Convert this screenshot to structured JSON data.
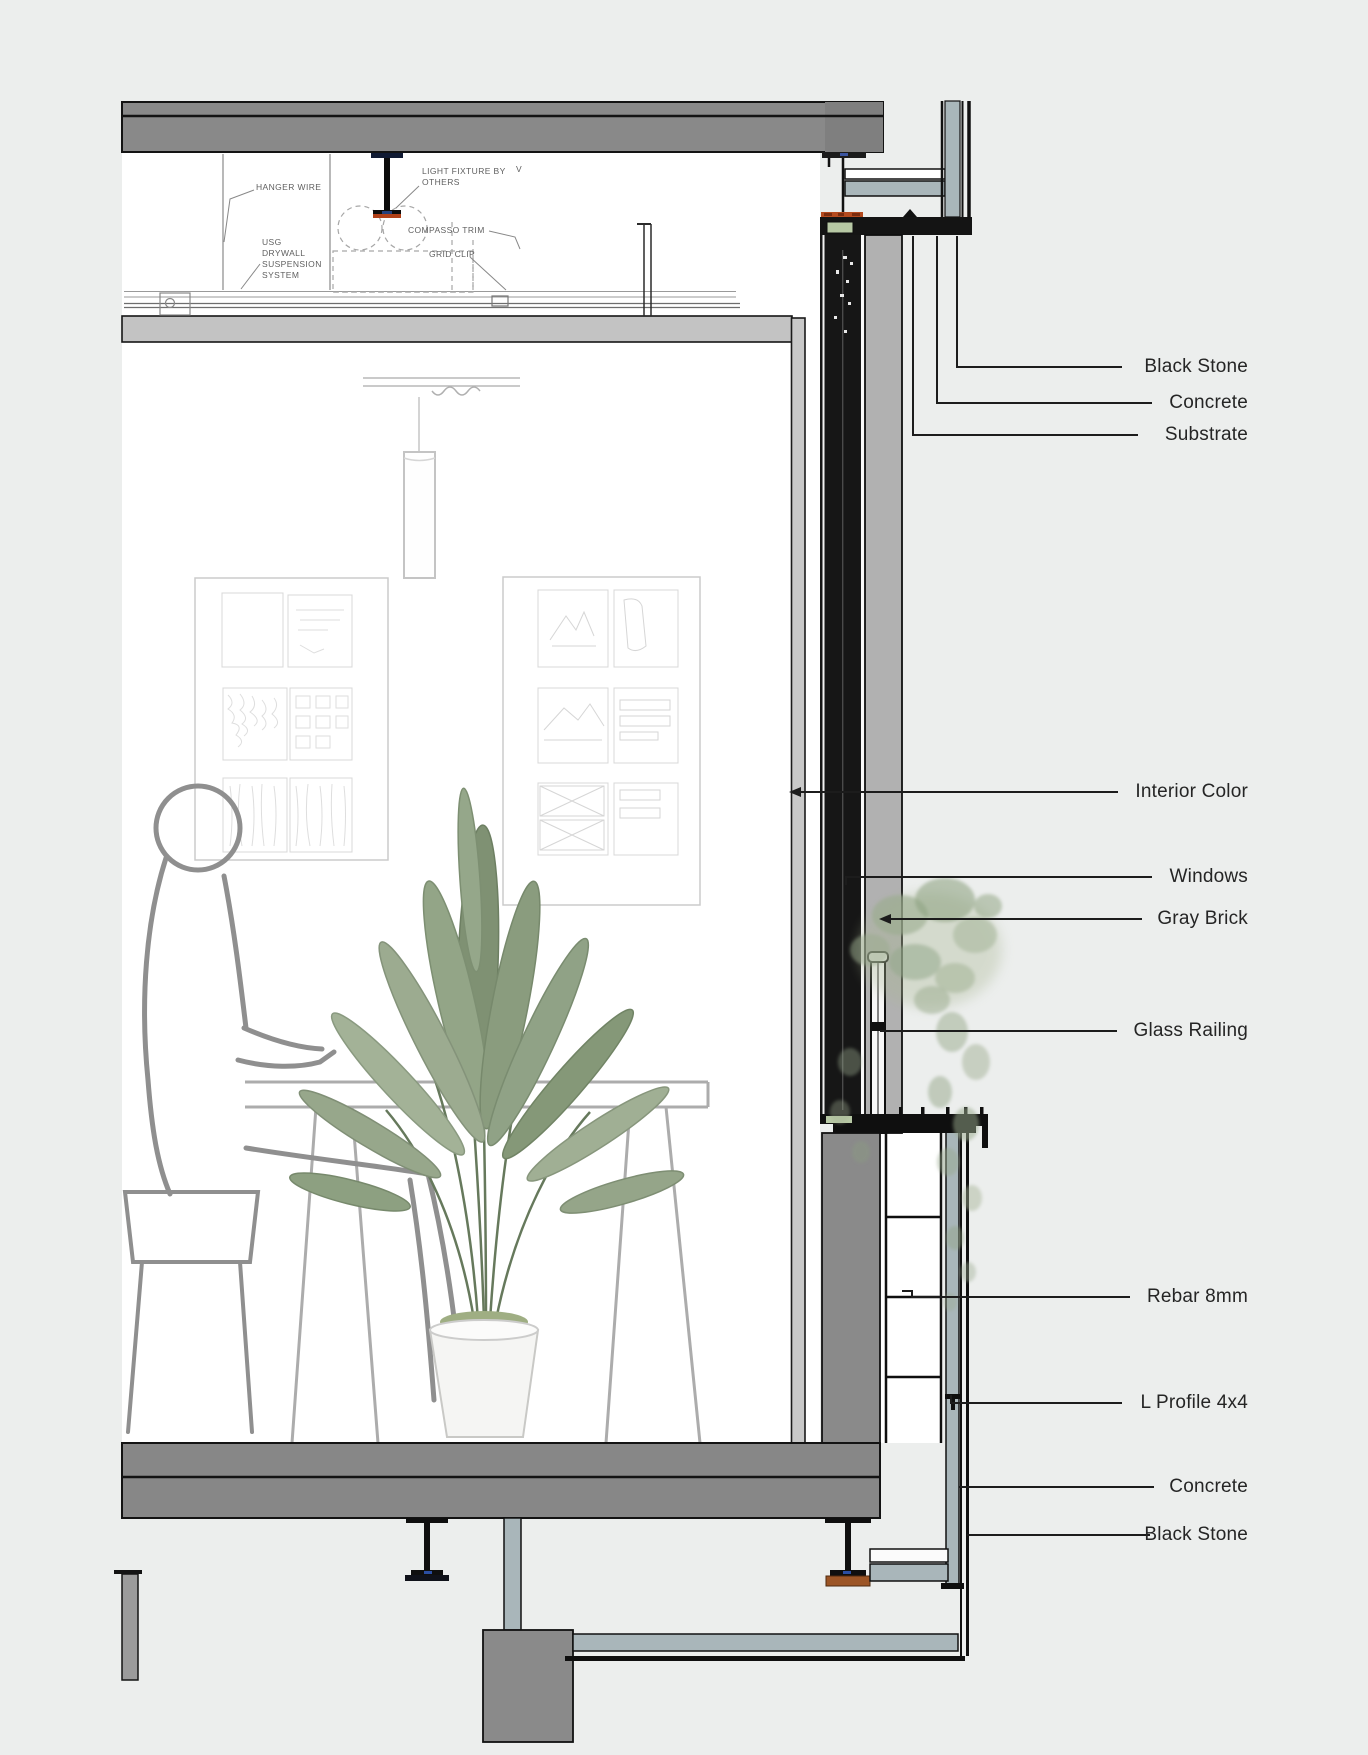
{
  "drawing": {
    "type": "architectural-wall-section-detail",
    "background": "#eceeed",
    "room_background": "#ffffff"
  },
  "colors": {
    "slab_gray": "#898989",
    "parapet_gray": "#8a8a8a",
    "gray_brick_band": "#b1b1b1",
    "interior_finish_strip": "#c8c8c8",
    "cladding_blue_gray": "#a9b6ba",
    "frame_black": "#141414",
    "glazing_green": "#b7c8a4",
    "sealant_orange": "#b44a1e",
    "bearing_pad_brown": "#9c5526",
    "leaf_green": "#8fa184",
    "sketch_gray": "#8f8f8f"
  },
  "callouts": {
    "items": [
      {
        "id": "black-stone-top",
        "label": "Black Stone"
      },
      {
        "id": "concrete-top",
        "label": "Concrete"
      },
      {
        "id": "substrate",
        "label": "Substrate"
      },
      {
        "id": "interior-color",
        "label": "Interior Color"
      },
      {
        "id": "windows",
        "label": "Windows"
      },
      {
        "id": "gray-brick",
        "label": "Gray Brick"
      },
      {
        "id": "glass-railing",
        "label": "Glass Railing"
      },
      {
        "id": "rebar-8mm",
        "label": "Rebar 8mm"
      },
      {
        "id": "l-profile-4x4",
        "label": "L Profile 4x4"
      },
      {
        "id": "concrete-bottom",
        "label": "Concrete"
      },
      {
        "id": "black-stone-bottom",
        "label": "Black Stone"
      }
    ]
  },
  "ceiling_annotations": {
    "hanger_wire": "HANGER WIRE",
    "light_fixture": "LIGHT FIXTURE BY\nOTHERS",
    "compasso_trim": "COMPASSO TRIM",
    "grid_clip": "GRID CLIP",
    "usg_system": "USG\nDRYWALL\nSUSPENSION\nSYSTEM",
    "v_mark": "V"
  }
}
